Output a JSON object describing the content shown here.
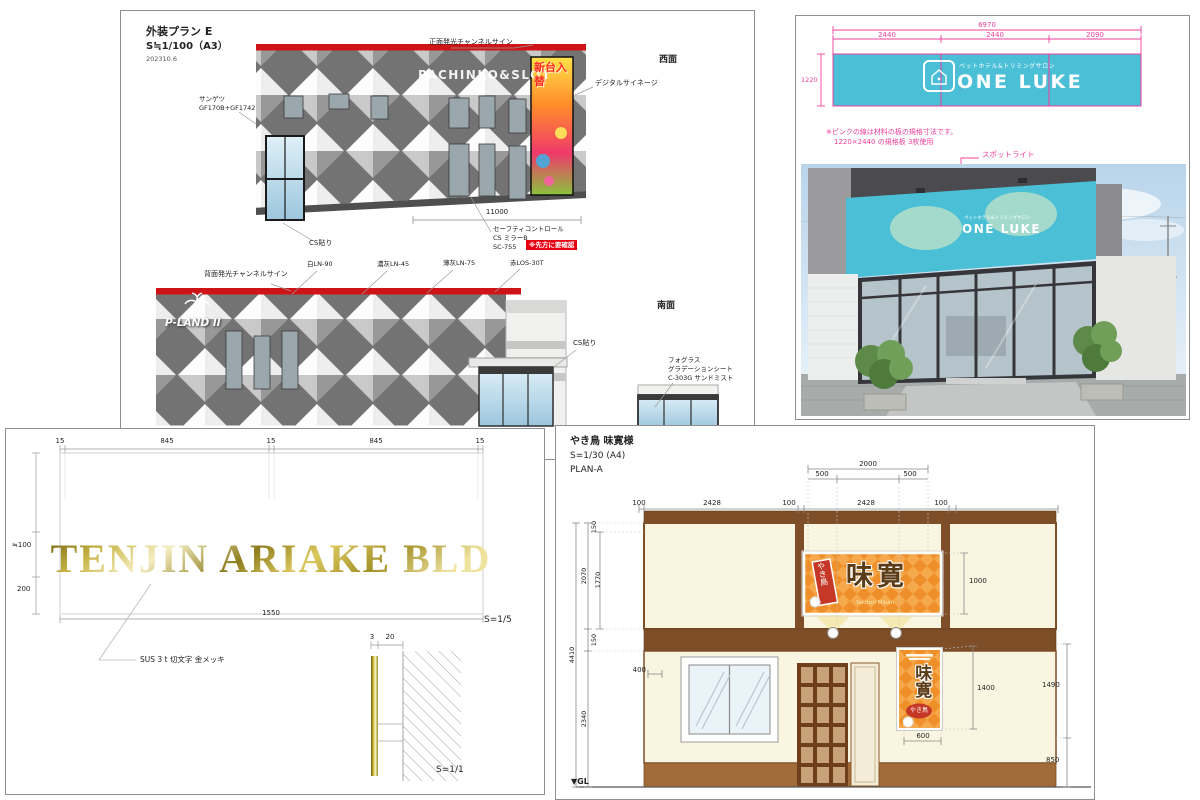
{
  "panel1": {
    "title": "外装プラン E",
    "scale": "S≒1/100（A3）",
    "date": "202310.6",
    "west": "西面",
    "south": "南面",
    "facade_text": "PACHINKO&SLOT",
    "poster_text": "新台入替",
    "logo_text": "P-LAND II",
    "ann_sangetsu1": "サンゲツ",
    "ann_sangetsu2": "GF170B+GF1742",
    "ann_front_sign": "正面発光チャンネルサイン",
    "ann_digital": "デジタルサイネージ",
    "ann_cs1": "CS貼り",
    "ann_cs2": "CS貼り",
    "dim_11000": "11000",
    "ann_safety1": "セーフティコントロール",
    "ann_safety2": "CS ミラーB",
    "ann_safety3": "SC-755",
    "badge": "※先方に要確認",
    "ann_back_sign": "背面発光チャンネルサイン",
    "ann_white": "白LN-90",
    "ann_dgrey": "濃灰LN-45",
    "ann_lgrey": "薄灰LN-75",
    "ann_red": "赤LOS-30T",
    "ann_fog1": "フォグラス",
    "ann_fog2": "グラデーションシート",
    "ann_fog3": "C-303G サンドミスト"
  },
  "panel2": {
    "dim_total": "6970",
    "dim_seg1": "2440",
    "dim_seg2": "2440",
    "dim_seg3": "2090",
    "dim_h": "1220",
    "sign_sub": "ペットホテル&トリミングサロン",
    "sign_main": "ONE LUKE",
    "note1": "※ピンクの線は材料の板の規格寸法です。",
    "note2": "1220×2440 の規格板 3枚使用",
    "ann_spotlight": "スポットライト"
  },
  "panel3": {
    "dims_top": [
      "15",
      "845",
      "15",
      "845",
      "15"
    ],
    "dim_h100": "≒100",
    "dim_h200": "200",
    "dim_w1550": "1550",
    "scale_main": "S=1/5",
    "scale_detail": "S=1/1",
    "sign_text": "TENJIN ARIAKE BLD",
    "ann_material": "SUS 3 t 切文字 金メッキ",
    "dim_t3": "3",
    "dim_d20": "20"
  },
  "panel4": {
    "title": "やき鳥 味寛様",
    "scale": "S=1/30 (A4)",
    "plan": "PLAN-A",
    "dim_2000": "2000",
    "dim_500a": "500",
    "dim_500b": "500",
    "dims_top": [
      "100",
      "2428",
      "100",
      "2428",
      "100"
    ],
    "dim_150a": "150",
    "dim_2070": "2070",
    "dim_1770": "1770",
    "dim_150b": "150",
    "dim_2340": "2340",
    "dim_4410": "4410",
    "dim_400": "400",
    "dim_600": "600",
    "dim_1000": "1000",
    "dim_1400": "1400",
    "dim_1490": "1490",
    "dim_850": "850",
    "gl": "▼GL",
    "sign_ribbon": "やき鳥",
    "sign_main": "味寛",
    "sign_caption": "Yakitori Mikan"
  },
  "colors": {
    "accent_red": "#cf1417",
    "sign_cyan": "#4abfd6",
    "dim_pink": "#ef3f9b",
    "gold": "#c6b243",
    "wood_brown": "#7d4e28",
    "sign_orange": "#ef8f2a"
  }
}
